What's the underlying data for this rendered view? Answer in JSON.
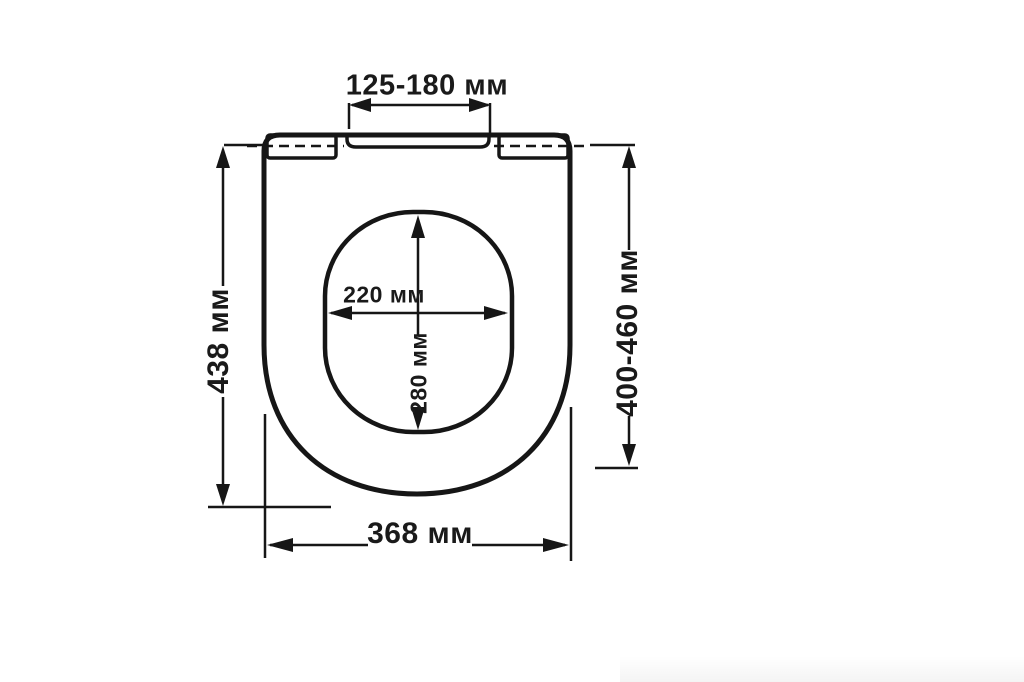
{
  "page": {
    "background_color": "#ffffff",
    "line_color": "#161616",
    "text_color": "#1a1a1a",
    "subject": "toilet-seat-dimension-drawing-top-view",
    "units": "мм"
  },
  "labels": {
    "hinge_spacing": "125-180 мм",
    "overall_length": "438 мм",
    "install_range": "400-460 мм",
    "overall_width": "368 мм",
    "opening_width": "220 мм",
    "opening_depth": "280 мм"
  }
}
